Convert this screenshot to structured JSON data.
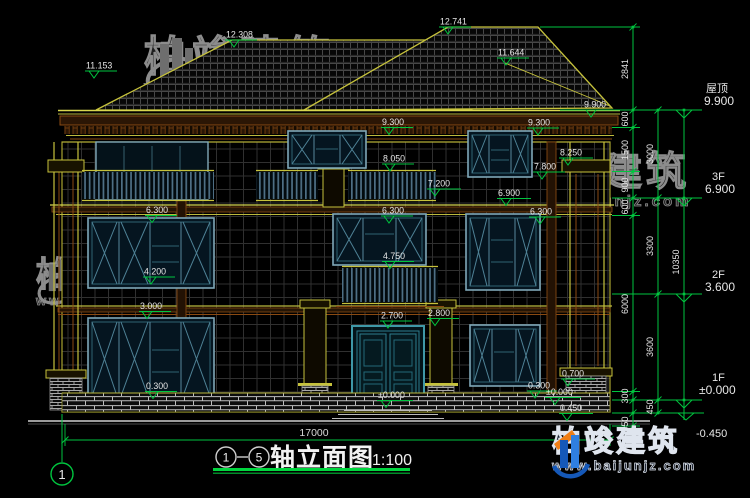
{
  "title_block": {
    "axis_a": "1",
    "axis_b": "5",
    "name": "轴立面图",
    "scale": "1:100",
    "total_width_dim": "17000",
    "axis_bubble": "1"
  },
  "floors": [
    {
      "name": "屋顶",
      "elev": "9.900"
    },
    {
      "name": "3F",
      "elev": "6.900"
    },
    {
      "name": "2F",
      "elev": "3.600"
    },
    {
      "name": "1F",
      "elev": "±0.000"
    },
    {
      "name": "",
      "elev": "-0.450"
    }
  ],
  "markers": [
    {
      "v": "11.153"
    },
    {
      "v": "12.308"
    },
    {
      "v": "12.741"
    },
    {
      "v": "11.644"
    },
    {
      "v": "9.900"
    },
    {
      "v": "9.300"
    },
    {
      "v": "9.300"
    },
    {
      "v": "8.050"
    },
    {
      "v": "8.250"
    },
    {
      "v": "7.800"
    },
    {
      "v": "7.200"
    },
    {
      "v": "6.900"
    },
    {
      "v": "6.300"
    },
    {
      "v": "6.300"
    },
    {
      "v": "6.300"
    },
    {
      "v": "4.750"
    },
    {
      "v": "4.200"
    },
    {
      "v": "3.000"
    },
    {
      "v": "2.700"
    },
    {
      "v": "2.800"
    },
    {
      "v": "0.300"
    },
    {
      "v": "0.700"
    },
    {
      "v": "0.300"
    },
    {
      "v": "±0.000"
    },
    {
      "v": "±0.000"
    },
    {
      "v": "0.450"
    }
  ],
  "dims": {
    "inner": [
      "2841",
      "600",
      "1500",
      "900",
      "600",
      "6000",
      "300",
      "450"
    ],
    "middle": [
      "3000",
      "3300",
      "3600",
      "450"
    ],
    "outer": [
      "10350"
    ]
  },
  "watermark": {
    "brand": "柏竣建筑",
    "url": "www.baijunjz.com"
  },
  "colors": {
    "dim_green": "#00c53f",
    "cad_yellow": "#c6c23c",
    "cad_brown": "#8a4a12",
    "frame_teal": "#7fa8b8",
    "text_white": "#e6e6e6"
  }
}
